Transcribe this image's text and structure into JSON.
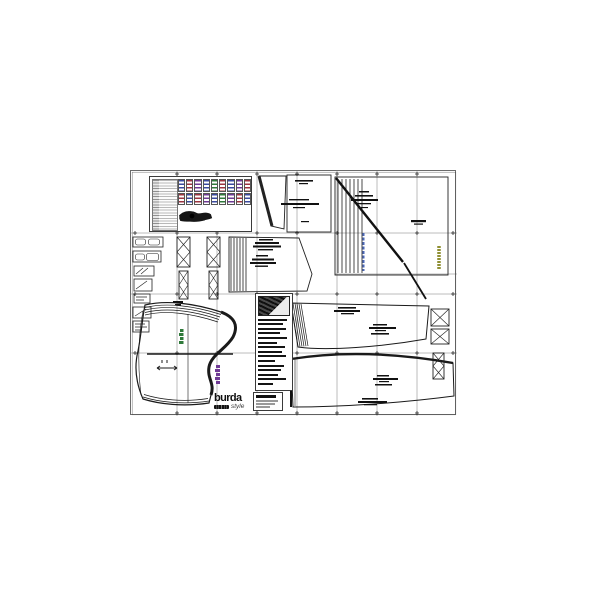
{
  "brand": {
    "name": "burda",
    "sub": "style"
  },
  "colors": {
    "paper": "#ffffff",
    "ink": "#1a1a1a",
    "sheet_border": "#6b6b6b",
    "grid": "#4a4a4a",
    "muted": "#8c8c8c",
    "accent_red": "#9d3440",
    "accent_blue": "#3a4a9f",
    "accent_purple": "#6f3a95",
    "accent_green": "#2f7a3a",
    "accent_olive": "#8f8f33",
    "web_blue": "#4a66b5"
  },
  "overview_panel": {
    "miniature_rows": 2,
    "miniature_columns": 9
  },
  "legend_panel": {
    "entry_count": 15
  }
}
